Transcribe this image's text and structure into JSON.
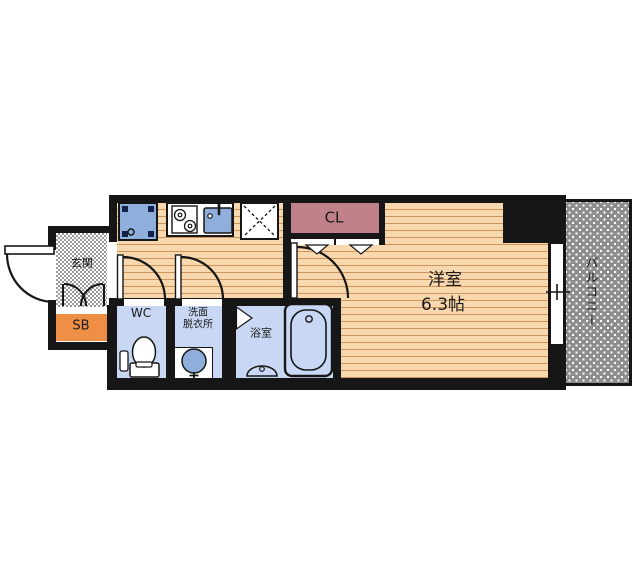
{
  "plan": {
    "type": "apartment-floor-plan",
    "rooms": {
      "genkan": {
        "label": "玄関"
      },
      "shoe_box": {
        "label": "SB"
      },
      "wc": {
        "label": "WC"
      },
      "washroom": {
        "label_line1": "洗面",
        "label_line2": "脱衣所"
      },
      "bathroom": {
        "label": "浴室"
      },
      "closet": {
        "label": "CL"
      },
      "main_room": {
        "label": "洋室",
        "size": "6.3帖"
      },
      "balcony": {
        "label": "バルコニー"
      }
    },
    "colors": {
      "wall": "#161616",
      "floor": "#F8D8AF",
      "floor_stripe": "#CF9459",
      "room_blue": "#C8D7F3",
      "fixture_blue": "#8FAEDC",
      "closet_pink": "#C1818A",
      "shoe_box_orange": "#EE8F45",
      "balcony_gray": "#8E8E8E",
      "entrance_checker": "#999999"
    }
  }
}
